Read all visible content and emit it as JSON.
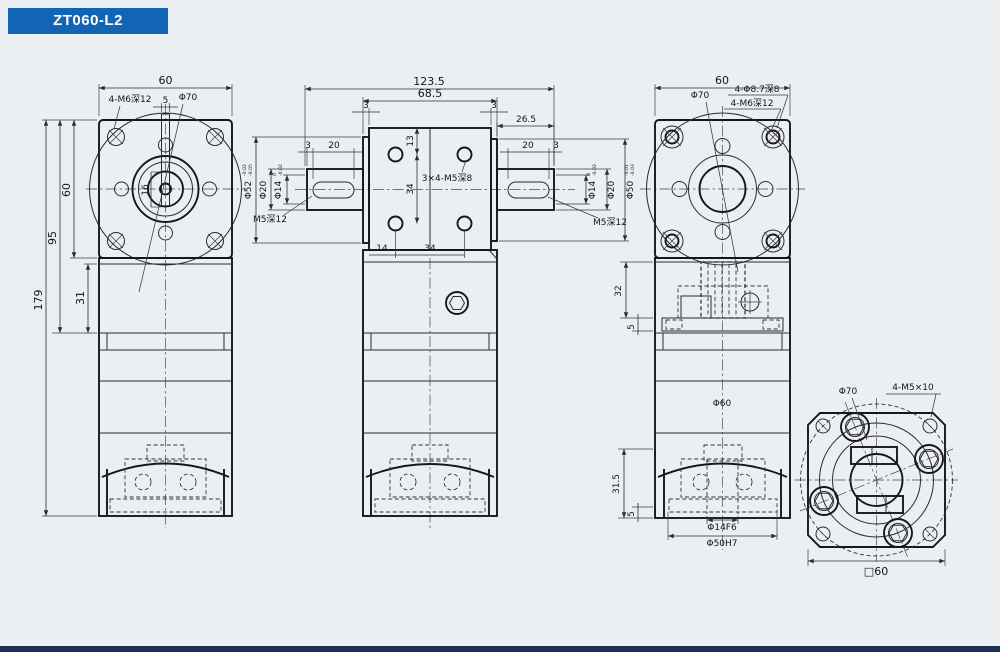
{
  "title": "ZT060-L2",
  "colors": {
    "accent": "#1165b4",
    "footer": "#1d2f56",
    "line": "#26262a",
    "background": "#eceff1"
  },
  "front_view": {
    "dim_top_width": "60",
    "label_corner_holes": "4-M6深12",
    "label_flange_dia": "Φ70",
    "dim_key_width": "5",
    "dim_key_len": "16",
    "dim_height_total": "179",
    "dim_height_95": "95",
    "dim_height_60": "60",
    "dim_height_31": "31"
  },
  "side_view": {
    "dim_total_len": "123.5",
    "dim_housing_len": "68.5",
    "dim_plate_left": "3",
    "dim_plate_right": "3",
    "dim_right_ext": "26.5",
    "dim_key_offset_left": "3",
    "dim_key_len_left": "20",
    "dim_key_len_right": "20",
    "dim_key_offset_right": "3",
    "dim_hole_top": "13",
    "dim_hole_pitch_v": "34",
    "label_holes": "3×4-M5深8",
    "dim_hole_left": "14",
    "dim_hole_pitch_h": "34",
    "left_shaft": {
      "dia_boss": "Φ52",
      "dia_boss_tol_up": "-0.02",
      "dia_boss_tol_dn": "-0.05",
      "dia_shaft": "Φ20",
      "dia_end": "Φ14",
      "dia_end_tol_up": "0",
      "dia_end_tol_dn": "-0.02",
      "label_thread": "M5深12"
    },
    "right_shaft": {
      "dia_end": "Φ14",
      "dia_end_tol_up": "0",
      "dia_end_tol_dn": "-0.02",
      "dia_shaft": "Φ20",
      "dia_boss": "Φ50",
      "dia_boss_tol_up": "-0.01",
      "dia_boss_tol_dn": "-0.03",
      "label_thread": "M5深12"
    }
  },
  "back_view": {
    "dim_top_width": "60",
    "label_flange_dia": "Φ70",
    "label_cbore_holes": "4-Φ8.7深8",
    "label_thread_holes": "4-M6深12",
    "dim_gear_height": "32",
    "dim_plate_height": "5",
    "label_body_dia": "Φ60",
    "dim_lower_height": "31.5",
    "dim_base_height": "5",
    "label_bore_fit": "Φ14F6",
    "label_spigot_fit": "Φ50H7"
  },
  "output_view": {
    "label_flange_dia": "Φ70",
    "label_screws": "4-M5×10",
    "dim_square": "□60"
  }
}
